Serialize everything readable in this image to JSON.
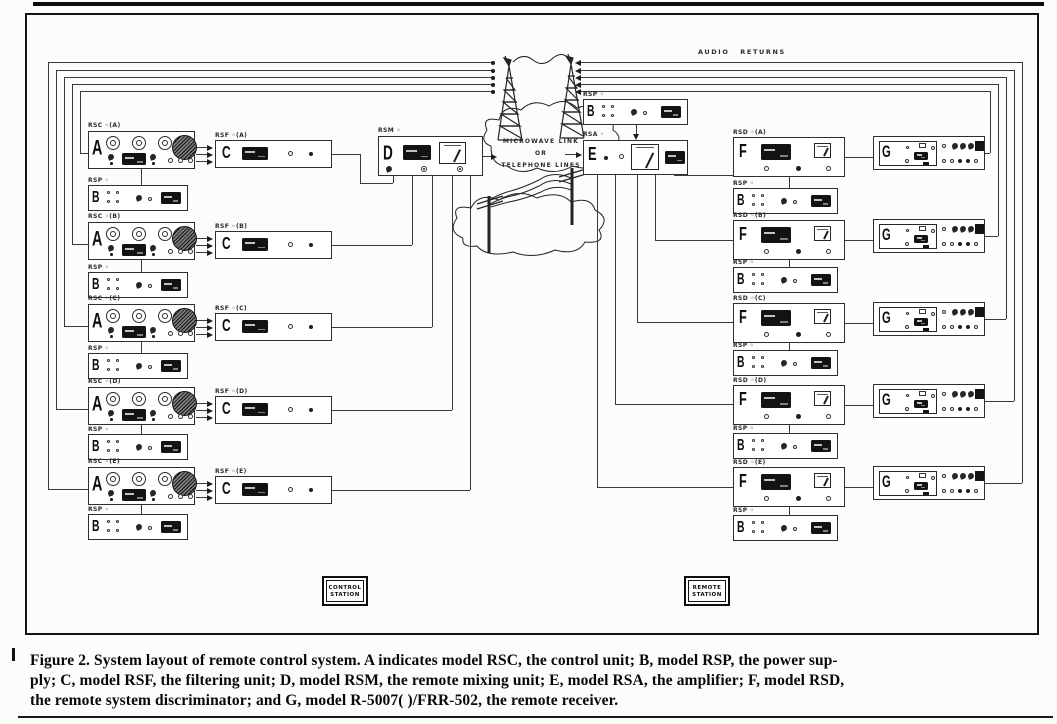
{
  "figure_caption": {
    "line1": "Figure 2.  System layout of remote control system.  A indicates model RSC, the control unit;  B, model RSP, the power sup-",
    "line2": "ply;  C, model RSF, the filtering unit;  D, model RSM, the remote mixing unit;  E, model RSA, the amplifier;  F, model  RSD,",
    "line3": "the remote system discriminator; and G, model R-5007(  )/FRR-502, the remote receiver."
  },
  "diagram": {
    "audio_returns_label": "AUDIO RETURNS",
    "link_cloud": {
      "line1": "MICROWAVE  LINK",
      "line2": "OR",
      "line3": "TELEPHONE  LINES"
    },
    "control_station": {
      "line1": "CONTROL",
      "line2": "STATION"
    },
    "remote_station": {
      "line1": "REMOTE",
      "line2": "STATION"
    },
    "mixer": {
      "tag": "RSM ◦",
      "letter": "D"
    },
    "amplifier": {
      "tag": "RSA ◦",
      "letter": "E"
    },
    "amplifier_psu": {
      "tag": "RSP ◦",
      "letter": "B"
    },
    "letters": {
      "control": "A",
      "psu": "B",
      "filter": "C",
      "discriminator": "F",
      "receiver": "G"
    },
    "left_rows": [
      {
        "id": "a",
        "control_tag": "RSC ◦(A)",
        "filter_tag": "RSF ◦(A)",
        "psu_tag": "RSP ◦"
      },
      {
        "id": "b",
        "control_tag": "RSC ◦(B)",
        "filter_tag": "RSF ◦(B)",
        "psu_tag": "RSP ◦"
      },
      {
        "id": "c",
        "control_tag": "RSC ◦(C)",
        "filter_tag": "RSF ◦(C)",
        "psu_tag": "RSP ◦"
      },
      {
        "id": "d",
        "control_tag": "RSC ◦(D)",
        "filter_tag": "RSF ◦(D)",
        "psu_tag": "RSP ◦"
      },
      {
        "id": "e",
        "control_tag": "RSC ◦(E)",
        "filter_tag": "RSF ◦(E)",
        "psu_tag": "RSP ◦"
      }
    ],
    "right_rows": [
      {
        "id": "a",
        "disc_tag": "RSD ◦(A)",
        "psu_tag": "RSP ◦"
      },
      {
        "id": "b",
        "disc_tag": "RSD ◦(B)",
        "psu_tag": "RSP ◦"
      },
      {
        "id": "c",
        "disc_tag": "RSD ◦(C)",
        "psu_tag": "RSP ◦"
      },
      {
        "id": "d",
        "disc_tag": "RSD ◦(D)",
        "psu_tag": "RSP ◦"
      },
      {
        "id": "e",
        "disc_tag": "RSD ◦(E)",
        "psu_tag": "RSP ◦"
      }
    ]
  },
  "colors": {
    "ink": "#1c1c1c",
    "paper": "#fcfcfa"
  }
}
